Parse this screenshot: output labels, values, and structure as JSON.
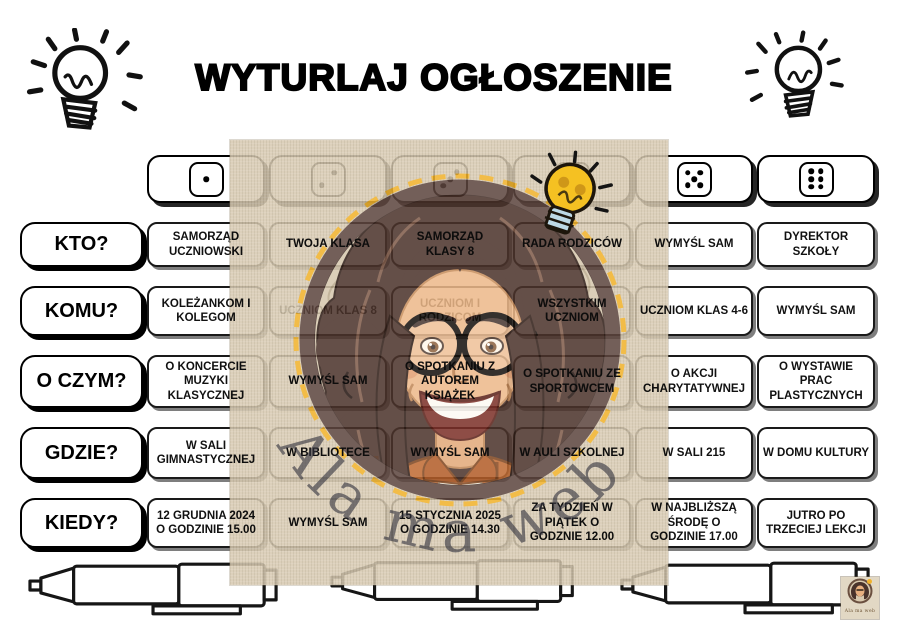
{
  "page": {
    "title": "WYTURLAJ OGŁOSZENIE",
    "watermark": "Ala ma web!"
  },
  "board": {
    "dice": [
      1,
      2,
      3,
      4,
      5,
      6
    ],
    "rows": [
      {
        "question": "KTO?",
        "cells": [
          {
            "text": "SAMORZĄD UCZNIOWSKI"
          },
          {
            "text": "TWOJA KLASA"
          },
          {
            "text": "SAMORZĄD KLASY 8"
          },
          {
            "text": "RADA RODZICÓW"
          },
          {
            "text": "WYMYŚL SAM"
          },
          {
            "text": "DYREKTOR SZKOŁY"
          }
        ]
      },
      {
        "question": "KOMU?",
        "cells": [
          {
            "text": "KOLEŻANKOM I KOLEGOM"
          },
          {
            "text": "UCZNIOM KLAS 8",
            "faded": true
          },
          {
            "text": "UCZNIOM I RODZICOM",
            "faded": true
          },
          {
            "text": "WSZYSTKIM UCZNIOM"
          },
          {
            "text": "UCZNIOM KLAS 4-6"
          },
          {
            "text": "WYMYŚL SAM"
          }
        ]
      },
      {
        "question": "O CZYM?",
        "cells": [
          {
            "text": "O KONCERCIE MUZYKI KLASYCZNEJ"
          },
          {
            "text": "WYMYŚL SAM"
          },
          {
            "text": "O SPOTKANIU Z AUTOREM KSIĄŻEK"
          },
          {
            "text": "O SPOTKANIU ZE SPORTOWCEM"
          },
          {
            "text": "O AKCJI CHARYTATYWNEJ"
          },
          {
            "text": "O WYSTAWIE PRAC PLASTYCZNYCH"
          }
        ]
      },
      {
        "question": "GDZIE?",
        "cells": [
          {
            "text": "W SALI GIMNASTYCZNEJ"
          },
          {
            "text": "W BIBLIOTECE"
          },
          {
            "text": "WYMYŚL SAM"
          },
          {
            "text": "W AULI SZKOLNEJ"
          },
          {
            "text": "W SALI 215"
          },
          {
            "text": "W DOMU KULTURY"
          }
        ]
      },
      {
        "question": "KIEDY?",
        "cells": [
          {
            "text": "12 GRUDNIA 2024 O GODZINIE 15.00"
          },
          {
            "text": "WYMYŚL SAM"
          },
          {
            "text": "15 STYCZNIA 2025 O GODZINIE 14.30"
          },
          {
            "text": "ZA TYDZIEŃ W PIĄTEK O GODZNIE 12.00"
          },
          {
            "text": "W NAJBLIŻSZĄ ŚRODĘ O GODZINIE 17.00"
          },
          {
            "text": "JUTRO PO TRZECIEJ LEKCJI"
          }
        ]
      }
    ]
  },
  "logo": {
    "text": "Ala ma web"
  },
  "colors": {
    "overlay_beige": "#d7c9b0",
    "ring_brown": "#5d453e",
    "dash_gold": "#f0b22b",
    "bulb_yellow": "#f5c122",
    "shirt_rust": "#bf6b33"
  }
}
